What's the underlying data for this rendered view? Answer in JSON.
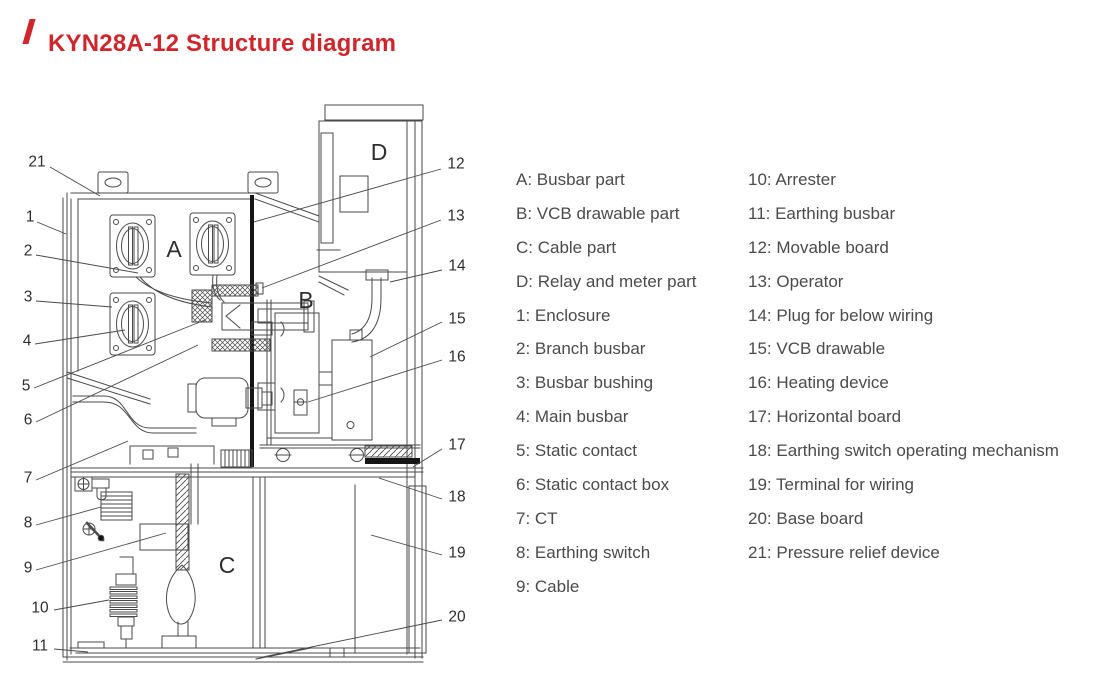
{
  "title": {
    "text": "KYN28A-12 Structure diagram"
  },
  "colors": {
    "accent_red": "#d0262b",
    "line_gray": "#4a4a4a",
    "legend_text": "#4b4b4e"
  },
  "legend": {
    "left": [
      "A: Busbar part",
      "B: VCB drawable part",
      "C: Cable part",
      "D: Relay and meter part",
      "1: Enclosure",
      "2: Branch busbar",
      "3: Busbar bushing",
      "4: Main busbar",
      "5: Static contact",
      "6: Static contact box",
      "7: CT",
      "8: Earthing switch",
      "9: Cable"
    ],
    "right": [
      "10: Arrester",
      "11: Earthing busbar",
      "12: Movable board",
      "13: Operator",
      "14: Plug for below wiring",
      "15: VCB drawable",
      "16: Heating device",
      "17: Horizontal board",
      "18: Earthing switch operating mechanism",
      "19: Terminal for wiring",
      "20: Base board",
      "21: Pressure relief device"
    ]
  },
  "diagram": {
    "section_labels": [
      {
        "label": "A",
        "x": 174,
        "y": 249
      },
      {
        "label": "B",
        "x": 306,
        "y": 300
      },
      {
        "label": "C",
        "x": 227,
        "y": 565
      },
      {
        "label": "D",
        "x": 379,
        "y": 152
      }
    ],
    "callouts": [
      {
        "label": "21",
        "tx": 37,
        "ty": 162,
        "x1": 50,
        "y1": 167,
        "x2": 100,
        "y2": 196
      },
      {
        "label": "1",
        "tx": 30,
        "ty": 217,
        "x1": 37,
        "y1": 222,
        "x2": 66,
        "y2": 234
      },
      {
        "label": "2",
        "tx": 28,
        "ty": 251,
        "x1": 36,
        "y1": 255,
        "x2": 138,
        "y2": 273
      },
      {
        "label": "3",
        "tx": 28,
        "ty": 297,
        "x1": 36,
        "y1": 301,
        "x2": 112,
        "y2": 307
      },
      {
        "label": "4",
        "tx": 27,
        "ty": 341,
        "x1": 35,
        "y1": 344,
        "x2": 125,
        "y2": 330
      },
      {
        "label": "5",
        "tx": 26,
        "ty": 386,
        "x1": 34,
        "y1": 388,
        "x2": 205,
        "y2": 320
      },
      {
        "label": "6",
        "tx": 28,
        "ty": 420,
        "x1": 36,
        "y1": 422,
        "x2": 198,
        "y2": 345
      },
      {
        "label": "7",
        "tx": 28,
        "ty": 478,
        "x1": 36,
        "y1": 480,
        "x2": 128,
        "y2": 441
      },
      {
        "label": "8",
        "tx": 28,
        "ty": 523,
        "x1": 36,
        "y1": 525,
        "x2": 101,
        "y2": 507
      },
      {
        "label": "9",
        "tx": 28,
        "ty": 568,
        "x1": 36,
        "y1": 570,
        "x2": 166,
        "y2": 533
      },
      {
        "label": "10",
        "tx": 40,
        "ty": 608,
        "x1": 54,
        "y1": 610,
        "x2": 109,
        "y2": 600
      },
      {
        "label": "11",
        "tx": 40,
        "ty": 646,
        "x1": 54,
        "y1": 649,
        "x2": 88,
        "y2": 652
      },
      {
        "label": "12",
        "tx": 456,
        "ty": 164,
        "x1": 441,
        "y1": 169,
        "x2": 254,
        "y2": 222
      },
      {
        "label": "13",
        "tx": 456,
        "ty": 216,
        "x1": 441,
        "y1": 220,
        "x2": 262,
        "y2": 288
      },
      {
        "label": "14",
        "tx": 457,
        "ty": 266,
        "x1": 442,
        "y1": 270,
        "x2": 390,
        "y2": 282
      },
      {
        "label": "15",
        "tx": 457,
        "ty": 319,
        "x1": 442,
        "y1": 322,
        "x2": 370,
        "y2": 357
      },
      {
        "label": "16",
        "tx": 457,
        "ty": 357,
        "x1": 442,
        "y1": 360,
        "x2": 308,
        "y2": 402
      },
      {
        "label": "17",
        "tx": 457,
        "ty": 445,
        "x1": 442,
        "y1": 449,
        "x2": 413,
        "y2": 467
      },
      {
        "label": "18",
        "tx": 457,
        "ty": 497,
        "x1": 442,
        "y1": 499,
        "x2": 379,
        "y2": 478
      },
      {
        "label": "19",
        "tx": 457,
        "ty": 553,
        "x1": 442,
        "y1": 555,
        "x2": 371,
        "y2": 535
      },
      {
        "label": "20",
        "tx": 457,
        "ty": 617,
        "x1": 442,
        "y1": 620,
        "x2": 263,
        "y2": 657
      }
    ]
  }
}
